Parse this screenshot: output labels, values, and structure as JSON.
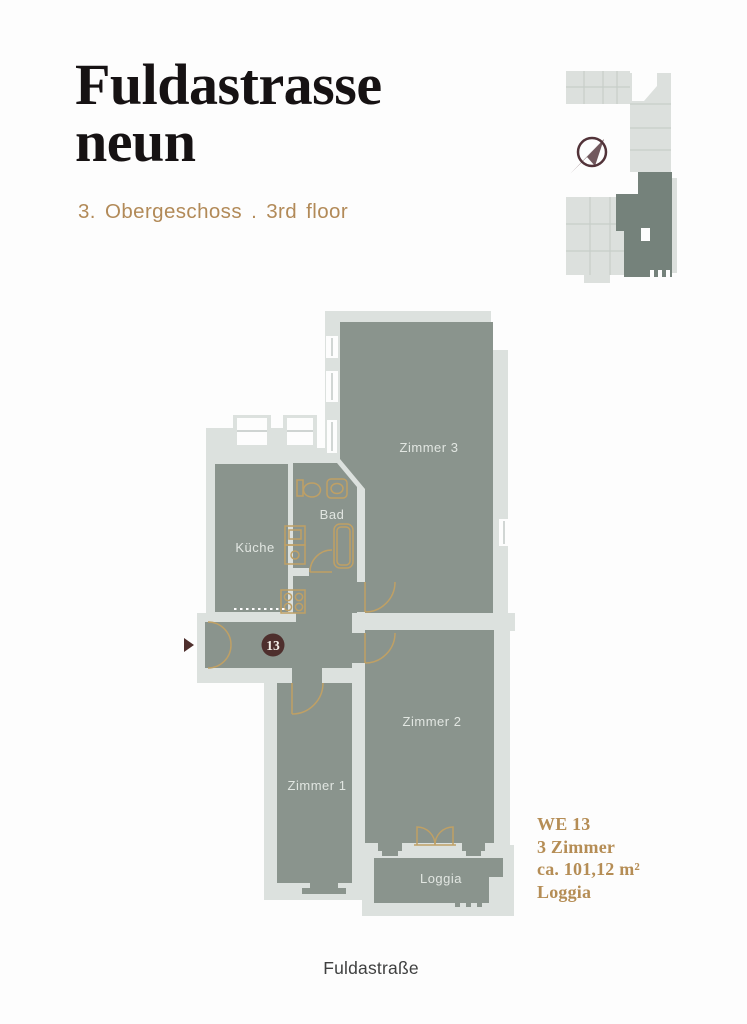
{
  "header": {
    "title_line1": "Fuldastrasse",
    "title_line2": "neun",
    "subtitle": "3. Obergeschoss . 3rd floor"
  },
  "floorplan": {
    "unit_badge": "13",
    "rooms": {
      "kueche": "Küche",
      "bad": "Bad",
      "zimmer3": "Zimmer 3",
      "zimmer1": "Zimmer 1",
      "zimmer2": "Zimmer 2",
      "loggia": "Loggia"
    }
  },
  "unit_info": {
    "unit_id": "WE 13",
    "rooms": "3 Zimmer",
    "area": "ca. 101,12 m²",
    "feature": "Loggia"
  },
  "footer": {
    "street": "Fuldastraße"
  },
  "colors": {
    "wall_light": "#dce1de",
    "room_fill": "#8a948d",
    "minimap_light": "#dce0dd",
    "minimap_highlight": "#75827b",
    "accent_gold": "#bfa065",
    "badge_maroon": "#4e2f2d",
    "title_text": "#161213",
    "subtitle_text": "#b28a58",
    "unit_text": "#b58d55"
  }
}
